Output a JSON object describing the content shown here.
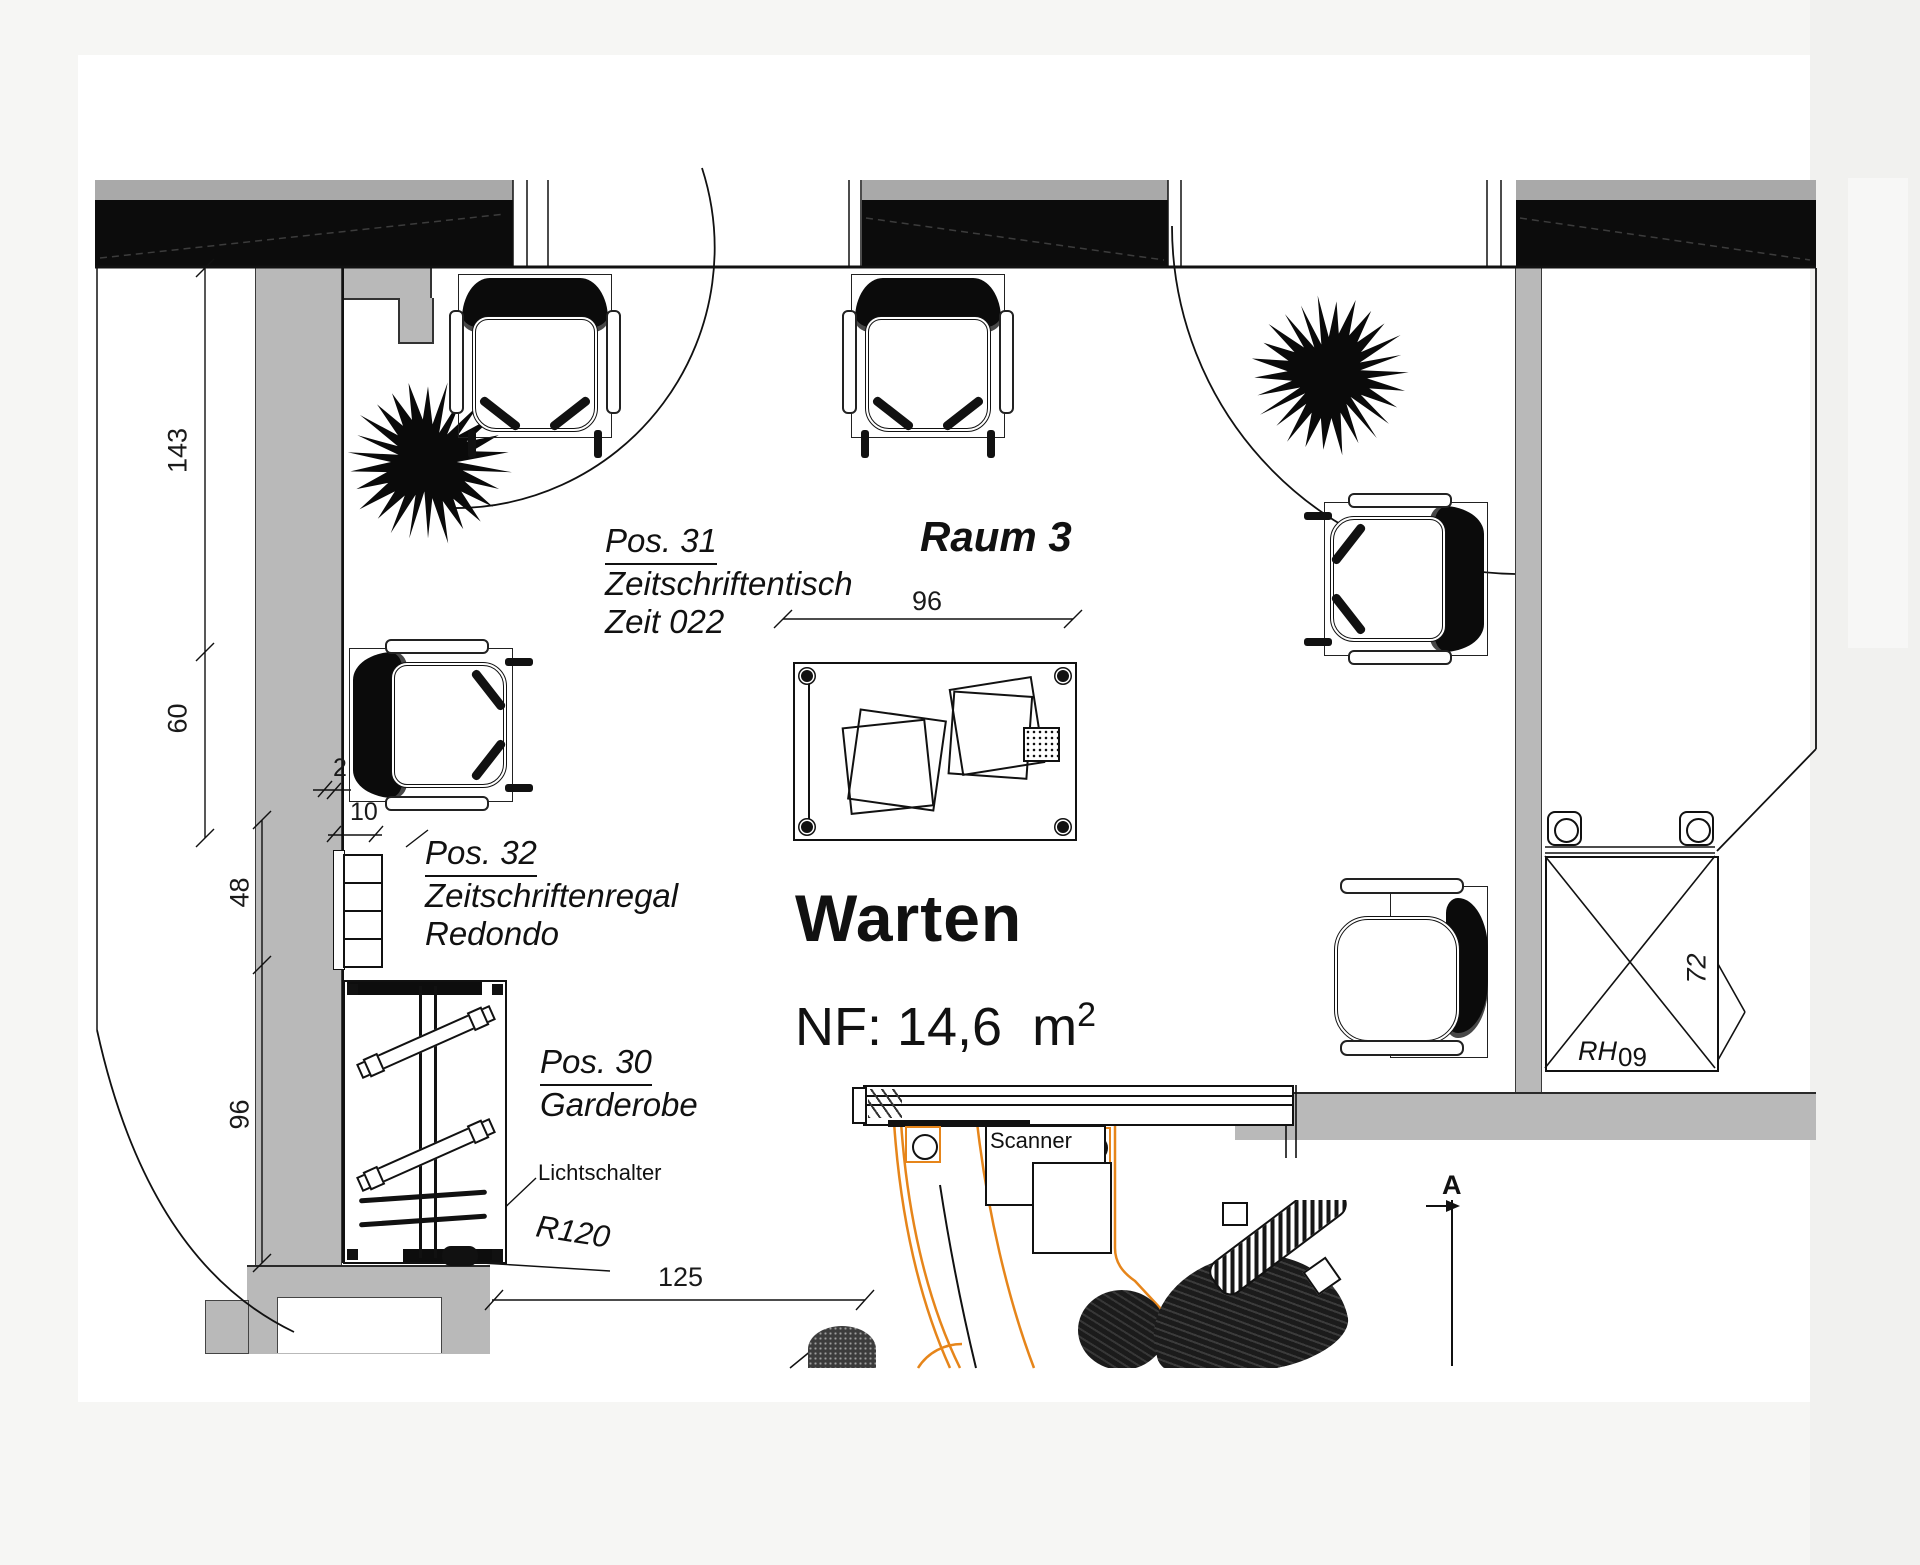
{
  "page": {
    "background": "#f6f6f4",
    "sheet": "#ffffff",
    "wall_fill": "#b9b9b9",
    "window_black": "#0c0c0c",
    "accent_orange": "#e6851a",
    "ink": "#111111"
  },
  "titles": {
    "room": "Raum 3",
    "zone": "Warten",
    "area_prefix": "NF: 14,6",
    "area_unit": "m",
    "area_exp": "2"
  },
  "labels": {
    "pos31": {
      "l1": "Pos. 31",
      "l2": "Zeitschriftentisch",
      "l3": "Zeit 022"
    },
    "pos32": {
      "l1": "Pos. 32",
      "l2": "Zeitschriftenregal",
      "l3": "Redondo"
    },
    "pos30": {
      "l1": "Pos. 30",
      "l2": "Garderobe"
    },
    "light_switch": "Lichtschalter",
    "door_radius": "R120",
    "scanner": "Scanner",
    "cabinet_code": "RH",
    "cabinet_num": "09",
    "section": "A"
  },
  "dimensions": {
    "left_chain": [
      "143",
      "60",
      "48",
      "96"
    ],
    "wall_offsets": [
      "2",
      "10"
    ],
    "table_width": "96",
    "clearance": "125",
    "cabinet_height": "72"
  }
}
